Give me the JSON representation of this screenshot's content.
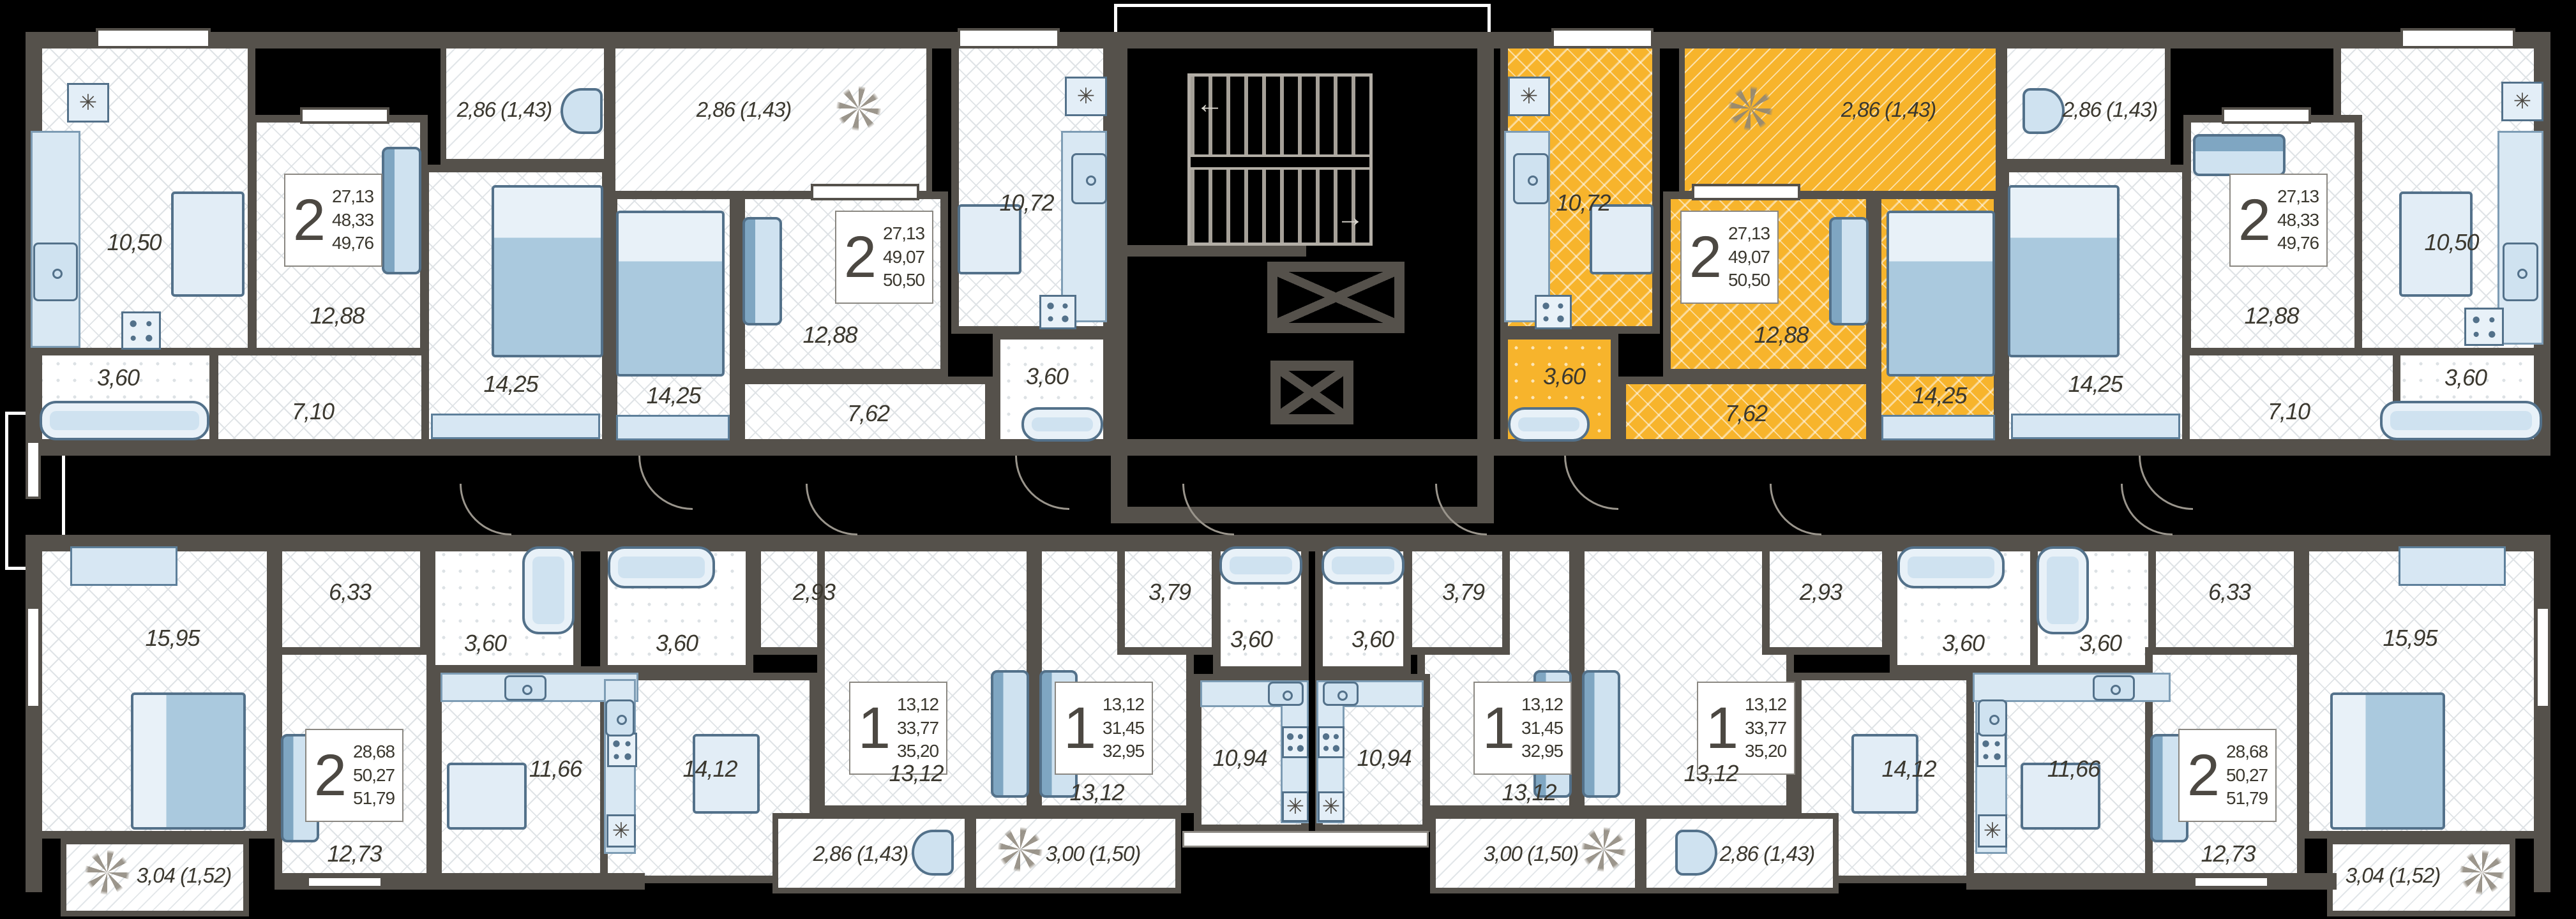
{
  "plan": {
    "title": "residential-floor-plan",
    "highlight_color": "#f7b42c",
    "wall_color": "#55514b",
    "apartments": {
      "t1": {
        "type_digit": "2",
        "stat": [
          "27,13",
          "48,33",
          "49,76"
        ],
        "highlighted": false,
        "rooms": {
          "kitchen": "10,50",
          "bathroom": "3,60",
          "living": "12,88",
          "hallway": "7,10",
          "bedroom": "14,25",
          "balcony": "2,86 (1,43)"
        }
      },
      "t2": {
        "type_digit": "2",
        "stat": [
          "27,13",
          "49,07",
          "50,50"
        ],
        "highlighted": false,
        "rooms": {
          "kitchen": "10,72",
          "bathroom": "3,60",
          "living": "12,88",
          "hallway": "7,62",
          "bedroom": "14,25",
          "balcony": "2,86 (1,43)"
        }
      },
      "t3": {
        "type_digit": "2",
        "stat": [
          "27,13",
          "49,07",
          "50,50"
        ],
        "highlighted": true,
        "rooms": {
          "kitchen": "10,72",
          "bathroom": "3,60",
          "living": "12,88",
          "hallway": "7,62",
          "bedroom": "14,25",
          "balcony": "2,86 (1,43)"
        }
      },
      "t4": {
        "type_digit": "2",
        "stat": [
          "27,13",
          "48,33",
          "49,76"
        ],
        "highlighted": false,
        "rooms": {
          "kitchen": "10,50",
          "bathroom": "3,60",
          "living": "12,88",
          "hallway": "7,10",
          "bedroom": "14,25",
          "balcony": "2,86 (1,43)"
        }
      },
      "b1": {
        "type_digit": "2",
        "stat": [
          "28,68",
          "50,27",
          "51,79"
        ],
        "highlighted": false,
        "rooms": {
          "bedroom": "15,95",
          "hallway": "6,33",
          "bathroom": "3,60",
          "living": "12,73",
          "kitchen": "11,66",
          "balcony": "3,04 (1,52)"
        }
      },
      "b2": {
        "type_digit": "1",
        "stat": [
          "13,12",
          "33,77",
          "35,20"
        ],
        "highlighted": false,
        "rooms": {
          "bathroom": "3,60",
          "hallway": "2,93",
          "kitchen": "14,12",
          "living": "13,12",
          "balcony": "2,86 (1,43)"
        }
      },
      "b3": {
        "type_digit": "1",
        "stat": [
          "13,12",
          "31,45",
          "32,95"
        ],
        "highlighted": false,
        "rooms": {
          "hallway": "3,79",
          "bathroom": "3,60",
          "kitchen": "10,94",
          "living": "13,12",
          "balcony": "3,00 (1,50)"
        }
      },
      "b4": {
        "type_digit": "1",
        "stat": [
          "13,12",
          "31,45",
          "32,95"
        ],
        "highlighted": false,
        "rooms": {
          "hallway": "3,79",
          "bathroom": "3,60",
          "kitchen": "10,94",
          "living": "13,12",
          "balcony": "3,00 (1,50)"
        }
      },
      "b5": {
        "type_digit": "1",
        "stat": [
          "13,12",
          "33,77",
          "35,20"
        ],
        "highlighted": false,
        "rooms": {
          "bathroom": "3,60",
          "hallway": "2,93",
          "kitchen": "14,12",
          "living": "13,12",
          "balcony": "2,86 (1,43)"
        }
      },
      "b6": {
        "type_digit": "2",
        "stat": [
          "28,68",
          "50,27",
          "51,79"
        ],
        "highlighted": false,
        "rooms": {
          "kitchen": "11,66",
          "living": "12,73",
          "bedroom": "15,95",
          "hallway": "6,33",
          "bathroom": "3,60",
          "balcony": "3,04 (1,52)"
        }
      }
    }
  }
}
